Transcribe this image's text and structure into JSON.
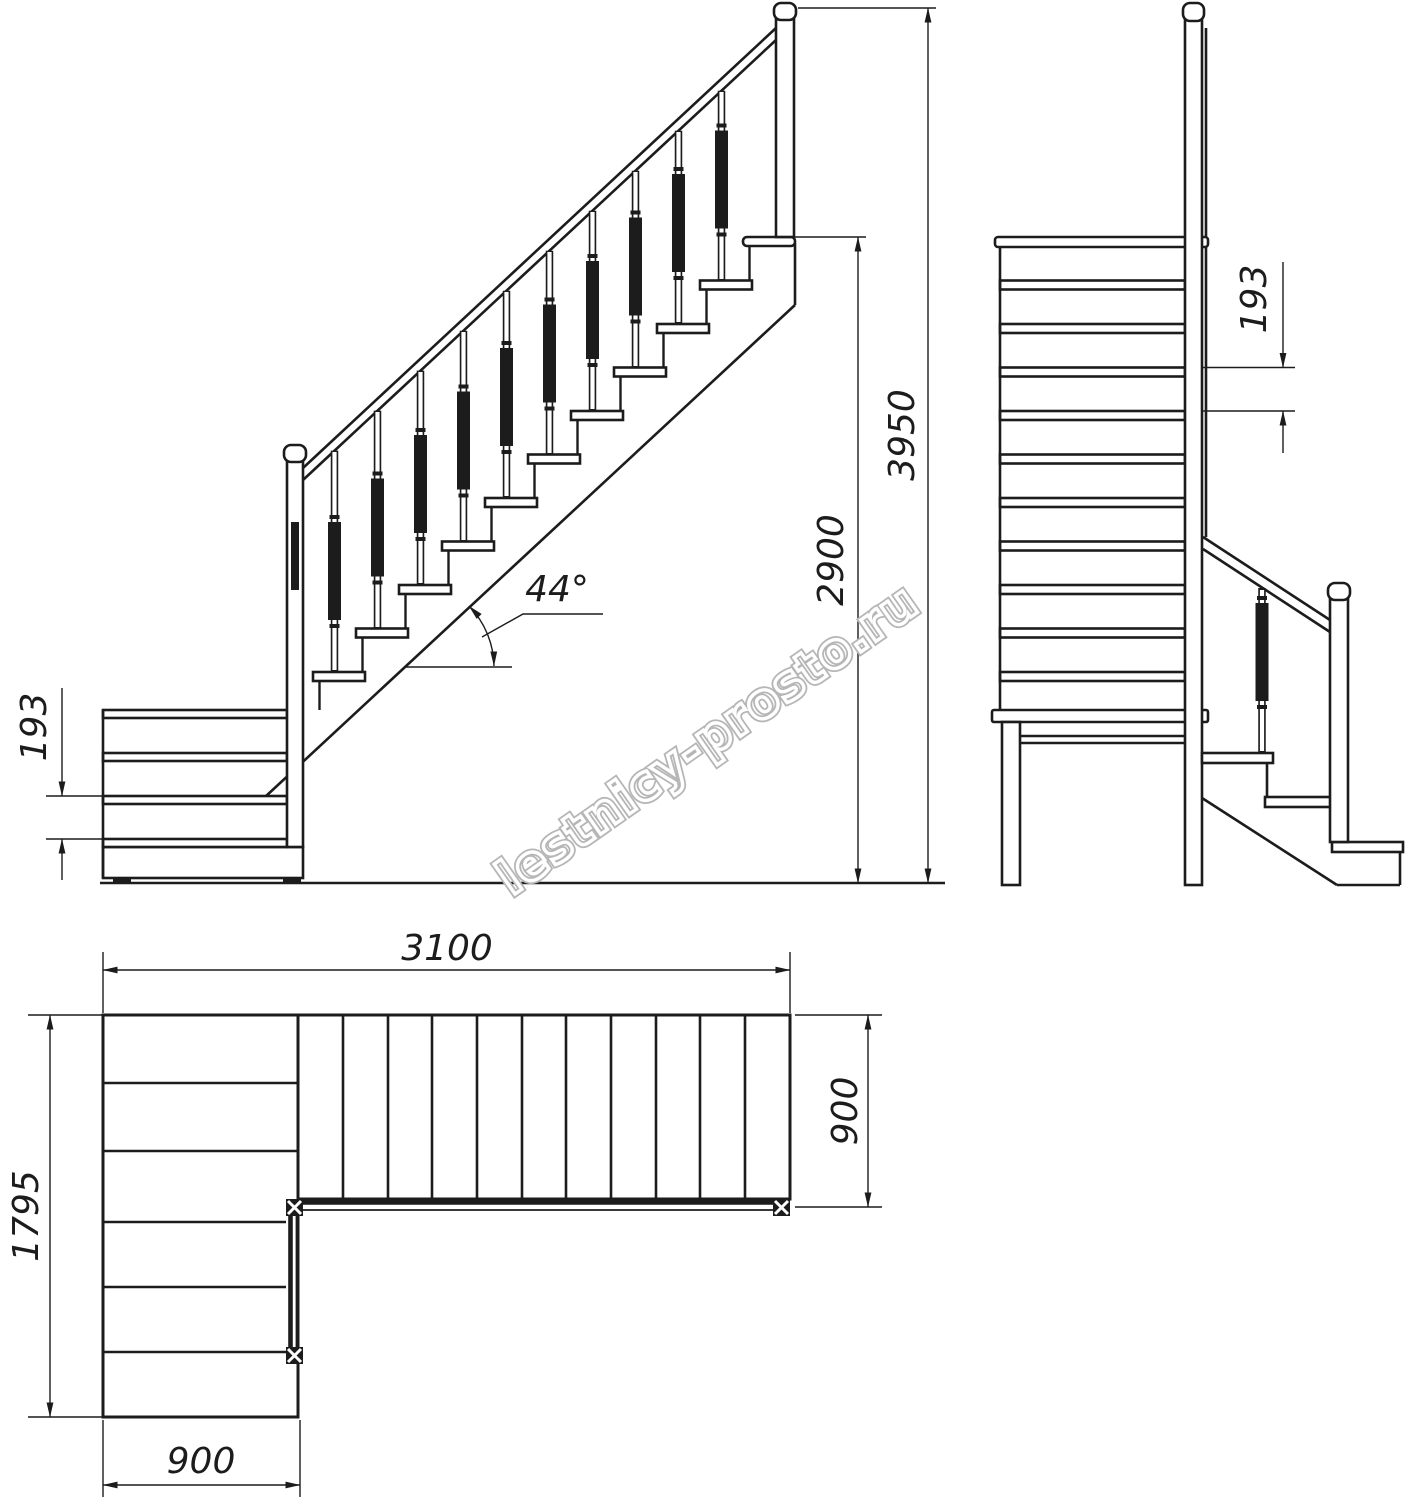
{
  "colors": {
    "line": "#1c1c1c",
    "watermark": "#b6b6b6",
    "background": "#ffffff"
  },
  "watermark": {
    "text": "lestnicy-prosto.ru"
  },
  "side_view": {
    "dim_total_height": "3950",
    "dim_flight_height": "2900",
    "dim_riser": "193",
    "dim_angle": "44°"
  },
  "front_view": {
    "dim_riser": "193"
  },
  "plan_view": {
    "dim_total_length": "3100",
    "dim_flight_width": "900",
    "dim_lower_length": "1795",
    "dim_lower_width": "900"
  }
}
